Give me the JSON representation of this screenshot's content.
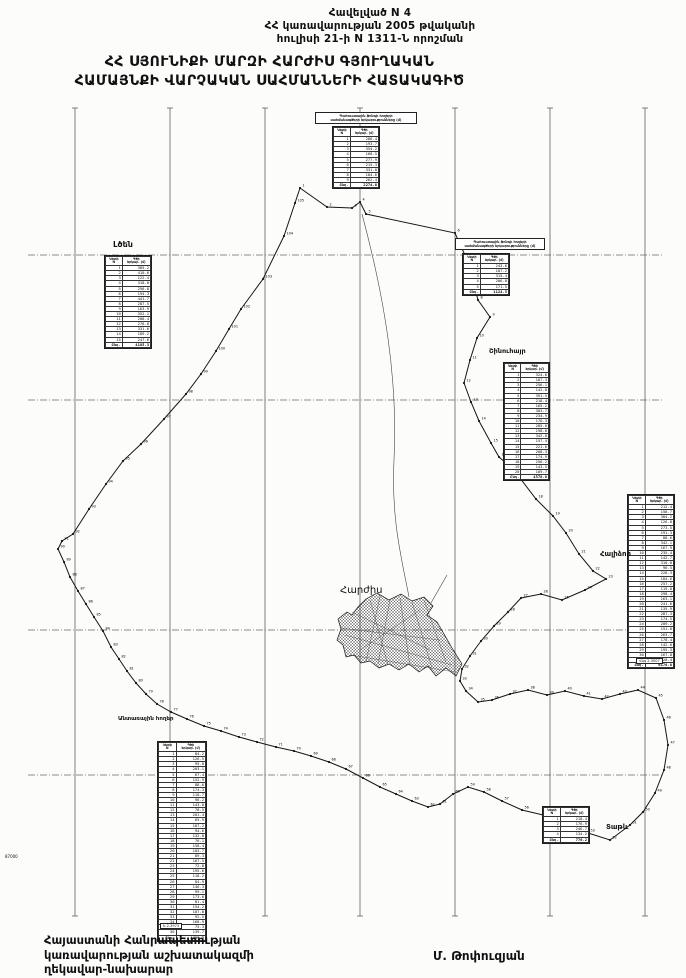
{
  "document": {
    "appendix_lines": [
      "Հավելված N 4",
      "ՀՀ կառավարության 2005 թվականի",
      "հուլիսի 21-ի N 1311-Ն որոշման"
    ],
    "title_lines": [
      "ՀՀ ՍՅՈՒՆԻՔԻ ՄԱՐԶԻ ՀԱՐԺԻՍ ԳՅՈՒՂԱԿԱՆ",
      "ՀԱՄԱՅՆՔԻ ՎԱՐՉԱԿԱՆ ՍԱՀՄԱՆՆԵՐԻ ՀԱՏԱԿԱԳԻԾ"
    ],
    "footer_left_lines": [
      "Հայաստանի Հանրապետության",
      "կառավարության աշխատակազմի",
      "ղեկավար-նախարար"
    ],
    "footer_right": "Մ. Թոփուզյան"
  },
  "map": {
    "ink_color": "#161616",
    "grid_color": "#4a4a4a",
    "grid": {
      "vertical_x": [
        75,
        170,
        265,
        360,
        455,
        550,
        645
      ],
      "top": 108,
      "bottom": 916,
      "horizontal_y": [
        255,
        400,
        630,
        775
      ],
      "left": 28,
      "right": 662
    },
    "center_label": "Հարժիս",
    "labels": [
      {
        "id": "ltsen",
        "text": "Լծեն",
        "x": 113,
        "y": 240,
        "size": 8,
        "bold": true,
        "boxed": false
      },
      {
        "id": "shinuhayr",
        "text": "Շինուհայր",
        "x": 489,
        "y": 347,
        "size": 6.5,
        "bold": true,
        "boxed": false
      },
      {
        "id": "halidzor",
        "text": "Հալիձոր",
        "x": 600,
        "y": 550,
        "size": 7,
        "bold": true,
        "boxed": false
      },
      {
        "id": "tatev",
        "text": "Տաթև",
        "x": 606,
        "y": 823,
        "size": 7,
        "bold": true,
        "boxed": false
      },
      {
        "id": "harjis",
        "text": "Հարժիս",
        "x": 340,
        "y": 585,
        "size": 10,
        "bold": false,
        "boxed": false
      },
      {
        "id": "forest-lands",
        "text": "Անտառային հողեր",
        "x": 118,
        "y": 716,
        "size": 5.5,
        "bold": true,
        "boxed": false
      },
      {
        "id": "coord-87000",
        "text": "87000",
        "x": 5,
        "y": 854,
        "size": 4,
        "bold": false,
        "boxed": false
      },
      {
        "id": "sheet-code-1",
        "text": "Ե 2-3973",
        "x": 160,
        "y": 923,
        "size": 3.5,
        "bold": false,
        "boxed": true
      },
      {
        "id": "sheet-code-2",
        "text": "Վկգ 2-3007",
        "x": 636,
        "y": 658,
        "size": 3.5,
        "bold": false,
        "boxed": true
      }
    ],
    "boundary_points": [
      [
        300,
        188
      ],
      [
        327,
        207
      ],
      [
        352,
        208
      ],
      [
        360,
        202
      ],
      [
        366,
        214
      ],
      [
        455,
        233
      ],
      [
        468,
        262
      ],
      [
        478,
        300
      ],
      [
        490,
        317
      ],
      [
        477,
        338
      ],
      [
        470,
        360
      ],
      [
        464,
        383
      ],
      [
        471,
        402
      ],
      [
        479,
        421
      ],
      [
        491,
        443
      ],
      [
        499,
        457
      ],
      [
        513,
        469
      ],
      [
        536,
        499
      ],
      [
        553,
        516
      ],
      [
        566,
        533
      ],
      [
        579,
        554
      ],
      [
        593,
        571
      ],
      [
        606,
        579
      ],
      [
        585,
        590
      ],
      [
        562,
        600
      ],
      [
        541,
        594
      ],
      [
        521,
        598
      ],
      [
        508,
        612
      ],
      [
        494,
        626
      ],
      [
        481,
        641
      ],
      [
        470,
        656
      ],
      [
        462,
        669
      ],
      [
        460,
        681
      ],
      [
        466,
        691
      ],
      [
        478,
        702
      ],
      [
        492,
        700
      ],
      [
        510,
        694
      ],
      [
        528,
        690
      ],
      [
        547,
        695
      ],
      [
        565,
        691
      ],
      [
        584,
        696
      ],
      [
        602,
        699
      ],
      [
        620,
        694
      ],
      [
        638,
        690
      ],
      [
        656,
        698
      ],
      [
        664,
        720
      ],
      [
        668,
        745
      ],
      [
        664,
        770
      ],
      [
        655,
        793
      ],
      [
        643,
        812
      ],
      [
        630,
        825
      ],
      [
        610,
        840
      ],
      [
        588,
        833
      ],
      [
        565,
        823
      ],
      [
        543,
        815
      ],
      [
        522,
        810
      ],
      [
        502,
        801
      ],
      [
        484,
        792
      ],
      [
        468,
        787
      ],
      [
        453,
        794
      ],
      [
        440,
        804
      ],
      [
        428,
        807
      ],
      [
        412,
        801
      ],
      [
        396,
        794
      ],
      [
        380,
        787
      ],
      [
        363,
        778
      ],
      [
        346,
        769
      ],
      [
        329,
        762
      ],
      [
        311,
        756
      ],
      [
        294,
        751
      ],
      [
        276,
        747
      ],
      [
        257,
        742
      ],
      [
        239,
        737
      ],
      [
        221,
        731
      ],
      [
        204,
        726
      ],
      [
        187,
        719
      ],
      [
        171,
        712
      ],
      [
        157,
        704
      ],
      [
        146,
        694
      ],
      [
        136,
        683
      ],
      [
        127,
        671
      ],
      [
        119,
        659
      ],
      [
        111,
        647
      ],
      [
        103,
        631
      ],
      [
        94,
        617
      ],
      [
        86,
        604
      ],
      [
        78,
        591
      ],
      [
        70,
        577
      ],
      [
        64,
        562
      ],
      [
        58,
        549
      ],
      [
        62,
        541
      ],
      [
        73,
        534
      ],
      [
        89,
        509
      ],
      [
        106,
        484
      ],
      [
        123,
        461
      ],
      [
        141,
        444
      ],
      [
        164,
        419
      ],
      [
        186,
        394
      ],
      [
        201,
        374
      ],
      [
        216,
        351
      ],
      [
        229,
        329
      ],
      [
        241,
        309
      ],
      [
        263,
        279
      ],
      [
        284,
        236
      ],
      [
        295,
        203
      ]
    ],
    "settlement_path": "M366,599 L377,593 L389,600 L401,594 L412,601 L424,597 L433,606 L427,615 L437,622 L444,634 L452,648 L462,664 L456,676 L446,668 L436,676 L428,666 L419,672 L409,664 L399,670 L389,664 L379,668 L370,661 L361,663 L354,655 L346,657 L343,645 L337,640 L341,629 L338,619 L347,612 L352,615 L358,607 Z",
    "settlement_detail": [
      "M352,612 L430,650",
      "M360,650 L420,610",
      "M345,635 L452,665",
      "M370,600 L388,665",
      "M400,598 L410,666",
      "M424,600 L446,662",
      "M380,596 L366,662",
      "M340,628 L440,640",
      "M350,655 L455,672",
      "M412,602 L432,668",
      "M390,600 L378,664"
    ],
    "roads": [
      "M362,214 C385,300 398,380 394,460 C391,520 402,560 409,597",
      "M447,575 L431,603"
    ],
    "tables": [
      {
        "id": "reserve-top",
        "pos": {
          "left": 332,
          "top": 126,
          "width": 46
        },
        "caption_pos": {
          "left": 315,
          "top": 112,
          "width": 96
        },
        "caption_lines": [
          "Պահուստային ֆոնդի հողերի",
          "սահմանագծերի երկարությունները (մ)"
        ],
        "headers": [
          "Կետի\nN",
          "Գծի\nերկար. (մ)"
        ],
        "rows": [
          [
            "1",
            "286.4"
          ],
          [
            "2",
            "193.7"
          ],
          [
            "3",
            "354.2"
          ],
          [
            "4",
            "168.5"
          ],
          [
            "5",
            "277.9"
          ],
          [
            "6",
            "215.3"
          ],
          [
            "7",
            "331.8"
          ],
          [
            "8",
            "184.6"
          ],
          [
            "9",
            "262.4"
          ]
        ],
        "total": [
          "Ընդ.",
          "2274.8"
        ]
      },
      {
        "id": "reserve-topright",
        "pos": {
          "left": 462,
          "top": 253,
          "width": 46
        },
        "caption_pos": {
          "left": 455,
          "top": 238,
          "width": 84
        },
        "caption_lines": [
          "Պահուստային ֆոնդի հողերի",
          "սահմանագծերի երկարությունները (մ)"
        ],
        "headers": [
          "Կետի\nN",
          "Գծի\nերկար. (մ)"
        ],
        "rows": [
          [
            "1",
            "243.6"
          ],
          [
            "2",
            "187.2"
          ],
          [
            "3",
            "315.4"
          ],
          [
            "4",
            "206.8"
          ],
          [
            "5",
            "171.5"
          ]
        ],
        "total": [
          "Ընդ.",
          "1124.5"
        ]
      },
      {
        "id": "ltsen",
        "pos": {
          "left": 104,
          "top": 255,
          "width": 46
        },
        "headers": [
          "Կետի\nN",
          "Գծի\nերկար. (մ)"
        ],
        "rows": [
          [
            "1",
            "385.2"
          ],
          [
            "2",
            "410.6"
          ],
          [
            "3",
            "122.4"
          ],
          [
            "4",
            "318.0"
          ],
          [
            "5",
            "256.8"
          ],
          [
            "6",
            "194.3"
          ],
          [
            "7",
            "441.7"
          ],
          [
            "8",
            "287.5"
          ],
          [
            "9",
            "163.9"
          ],
          [
            "10",
            "352.1"
          ],
          [
            "11",
            "208.4"
          ],
          [
            "12",
            "276.0"
          ],
          [
            "13",
            "331.6"
          ],
          [
            "14",
            "189.2"
          ],
          [
            "15",
            "247.6"
          ]
        ],
        "total": [
          "Ընդ.",
          "4185.3"
        ]
      },
      {
        "id": "shinuhayr",
        "pos": {
          "left": 503,
          "top": 362,
          "width": 45
        },
        "headers": [
          "Կետի\nN",
          "Գծի\nերկար. (մ)"
        ],
        "rows": [
          [
            "1",
            "324.6"
          ],
          [
            "2",
            "187.3"
          ],
          [
            "3",
            "256.1"
          ],
          [
            "4",
            "142.8"
          ],
          [
            "5",
            "391.5"
          ],
          [
            "6",
            "218.4"
          ],
          [
            "7",
            "165.2"
          ],
          [
            "8",
            "303.7"
          ],
          [
            "9",
            "234.9"
          ],
          [
            "10",
            "176.3"
          ],
          [
            "11",
            "285.0"
          ],
          [
            "12",
            "198.6"
          ],
          [
            "13",
            "342.8"
          ],
          [
            "14",
            "157.4"
          ],
          [
            "15",
            "221.6"
          ],
          [
            "16",
            "208.3"
          ],
          [
            "17",
            "174.9"
          ],
          [
            "18",
            "256.2"
          ],
          [
            "19",
            "143.5"
          ],
          [
            "20",
            "189.7"
          ]
        ],
        "total": [
          "Ընդ.",
          "4578.8"
        ]
      },
      {
        "id": "halidzor",
        "pos": {
          "left": 627,
          "top": 494,
          "width": 46
        },
        "headers": [
          "Կետի\nN",
          "Գծի\nերկար. (մ)"
        ],
        "rows": [
          [
            "1",
            "212.4"
          ],
          [
            "2",
            "158.7"
          ],
          [
            "3",
            "304.2"
          ],
          [
            "4",
            "126.8"
          ],
          [
            "5",
            "273.5"
          ],
          [
            "6",
            "191.3"
          ],
          [
            "7",
            "88.6"
          ],
          [
            "8",
            "342.1"
          ],
          [
            "9",
            "167.9"
          ],
          [
            "10",
            "235.4"
          ],
          [
            "11",
            "142.7"
          ],
          [
            "12",
            "310.8"
          ],
          [
            "13",
            "96.5"
          ],
          [
            "14",
            "228.3"
          ],
          [
            "15",
            "184.6"
          ],
          [
            "16",
            "257.2"
          ],
          [
            "17",
            "119.8"
          ],
          [
            "18",
            "298.4"
          ],
          [
            "19",
            "163.1"
          ],
          [
            "20",
            "241.6"
          ],
          [
            "21",
            "135.9"
          ],
          [
            "22",
            "287.3"
          ],
          [
            "23",
            "174.5"
          ],
          [
            "24",
            "209.2"
          ],
          [
            "25",
            "151.8"
          ],
          [
            "26",
            "263.7"
          ],
          [
            "27",
            "178.4"
          ],
          [
            "28",
            "142.6"
          ],
          [
            "29",
            "195.3"
          ],
          [
            "30",
            "167.8"
          ],
          [
            "31",
            "128.4"
          ]
        ],
        "total": [
          "Ընդ.",
          "6178.8"
        ]
      },
      {
        "id": "forest",
        "pos": {
          "left": 157,
          "top": 741,
          "width": 48
        },
        "headers": [
          "Կետի\nN",
          "Գծի\nերկար. (մ)"
        ],
        "rows": [
          [
            "1",
            "84.2"
          ],
          [
            "2",
            "126.5"
          ],
          [
            "3",
            "95.8"
          ],
          [
            "4",
            "203.1"
          ],
          [
            "5",
            "67.4"
          ],
          [
            "6",
            "152.9"
          ],
          [
            "7",
            "88.6"
          ],
          [
            "8",
            "174.3"
          ],
          [
            "9",
            "110.7"
          ],
          [
            "10",
            "96.2"
          ],
          [
            "11",
            "143.8"
          ],
          [
            "12",
            "78.5"
          ],
          [
            "13",
            "201.4"
          ],
          [
            "14",
            "65.9"
          ],
          [
            "15",
            "187.2"
          ],
          [
            "16",
            "94.6"
          ],
          [
            "17",
            "132.8"
          ],
          [
            "18",
            "76.1"
          ],
          [
            "19",
            "158.4"
          ],
          [
            "20",
            "103.7"
          ],
          [
            "21",
            "89.3"
          ],
          [
            "22",
            "167.5"
          ],
          [
            "23",
            "72.8"
          ],
          [
            "24",
            "195.6"
          ],
          [
            "25",
            "118.2"
          ],
          [
            "26",
            "84.9"
          ],
          [
            "27",
            "146.3"
          ],
          [
            "28",
            "99.1"
          ],
          [
            "29",
            "173.6"
          ],
          [
            "30",
            "81.4"
          ],
          [
            "31",
            "154.2"
          ],
          [
            "32",
            "107.8"
          ],
          [
            "33",
            "92.5"
          ],
          [
            "34",
            "168.9"
          ],
          [
            "35",
            "75.3"
          ],
          [
            "36",
            "139.7"
          ]
        ],
        "total": [
          "Ընդ.",
          "4409.2"
        ]
      },
      {
        "id": "tatev-small",
        "pos": {
          "left": 542,
          "top": 806,
          "width": 46
        },
        "headers": [
          "Կետի\nN",
          "Գծի\nերկար. (մ)"
        ],
        "rows": [
          [
            "1",
            "218.4"
          ],
          [
            "2",
            "176.9"
          ],
          [
            "3",
            "246.7"
          ],
          [
            "4",
            "134.2"
          ]
        ],
        "total": [
          "Ընդ.",
          "776.2"
        ]
      }
    ]
  }
}
